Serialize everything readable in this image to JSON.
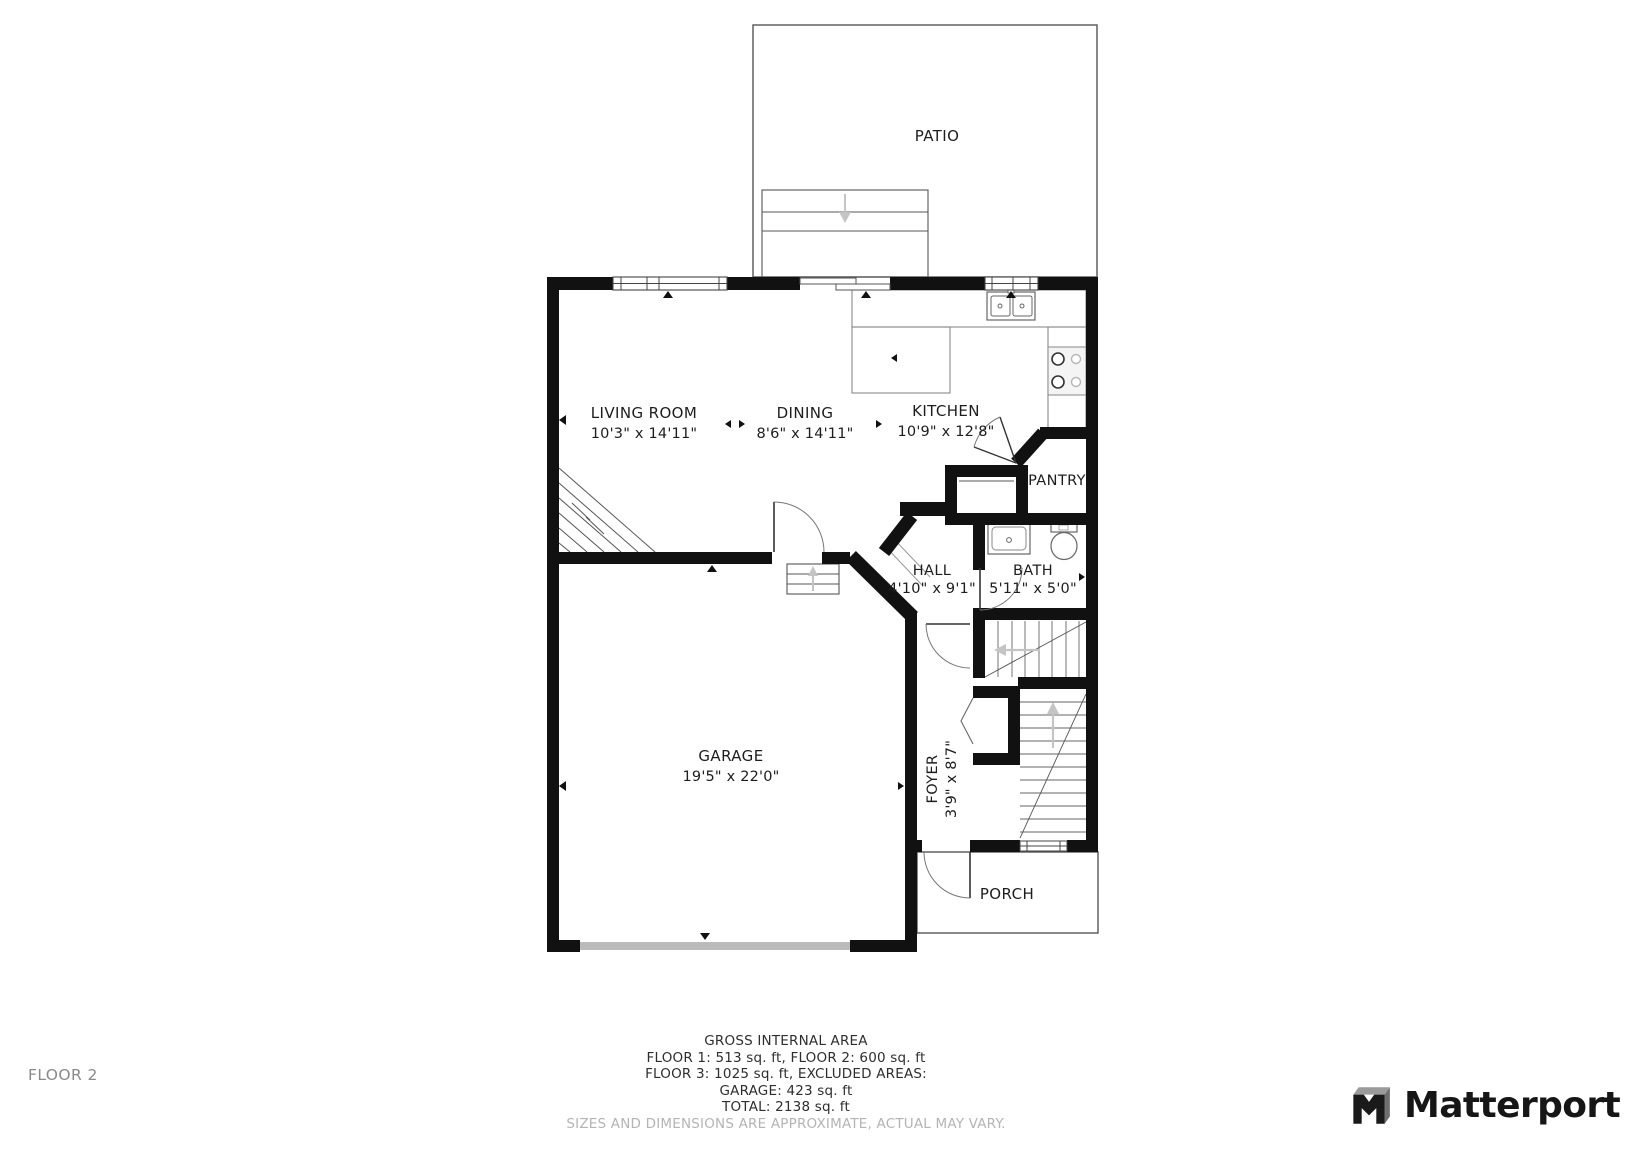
{
  "page": {
    "floor_label": "FLOOR 2"
  },
  "brand": {
    "name": "Matterport"
  },
  "rooms": {
    "patio": {
      "name": "PATIO"
    },
    "living_room": {
      "name": "LIVING ROOM",
      "dims": "10'3\" x 14'11\""
    },
    "dining": {
      "name": "DINING",
      "dims": "8'6\" x 14'11\""
    },
    "kitchen": {
      "name": "KITCHEN",
      "dims": "10'9\" x 12'8\""
    },
    "pantry": {
      "name": "PANTRY"
    },
    "hall": {
      "name": "HALL",
      "dims": "4'10\" x 9'1\""
    },
    "bath": {
      "name": "BATH",
      "dims": "5'11\" x 5'0\""
    },
    "garage": {
      "name": "GARAGE",
      "dims": "19'5\" x 22'0\""
    },
    "foyer": {
      "name": "FOYER",
      "dims": "3'9\" x 8'7\""
    },
    "porch": {
      "name": "PORCH"
    }
  },
  "footer": {
    "title": "GROSS INTERNAL AREA",
    "line1": "FLOOR 1: 513 sq. ft, FLOOR 2: 600 sq. ft",
    "line2": "FLOOR 3: 1025 sq. ft, EXCLUDED AREAS:",
    "line3": "GARAGE: 423 sq. ft",
    "line4": "TOTAL: 2138 sq. ft",
    "disclaimer": "SIZES AND DIMENSIONS ARE APPROXIMATE, ACTUAL MAY VARY."
  },
  "colors": {
    "wall": "#111111",
    "outline": "#555555",
    "fixture": "#777777",
    "stair_arrow": "#c4c4c4",
    "label": "#1d1d1d"
  }
}
